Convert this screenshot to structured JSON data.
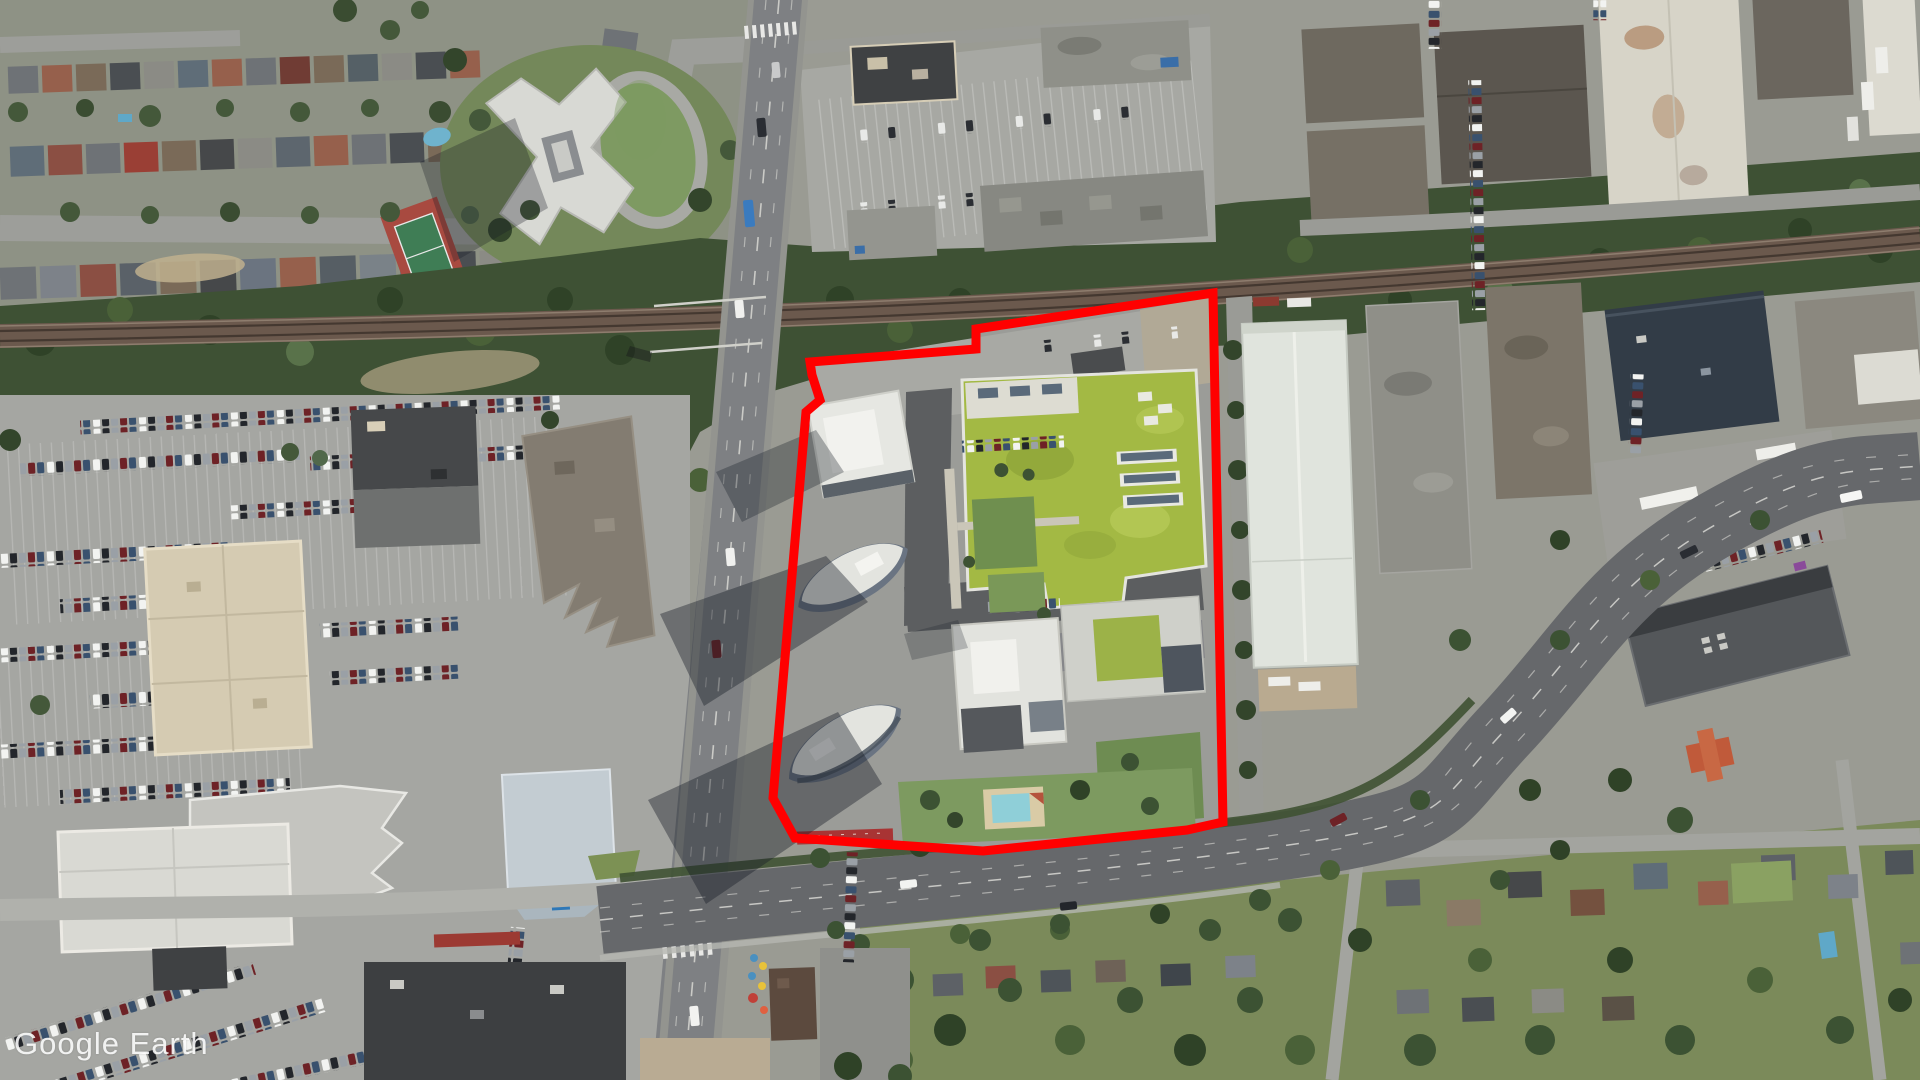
{
  "app": {
    "title": "Google Earth aerial imagery"
  },
  "watermark": {
    "text": "Google Earth",
    "color": "#ffffff"
  },
  "annotation": {
    "label": "site-boundary-outline",
    "stroke_color": "#ff0000",
    "stroke_width": "9",
    "points": "810,362 976,349 976,329 1213,293 1223,822 1187,830 983,851 795,838 773,798 806,412 820,400 812,375"
  },
  "view": {
    "width": "1920",
    "height": "1080",
    "imagery": "satellite-aerial"
  }
}
